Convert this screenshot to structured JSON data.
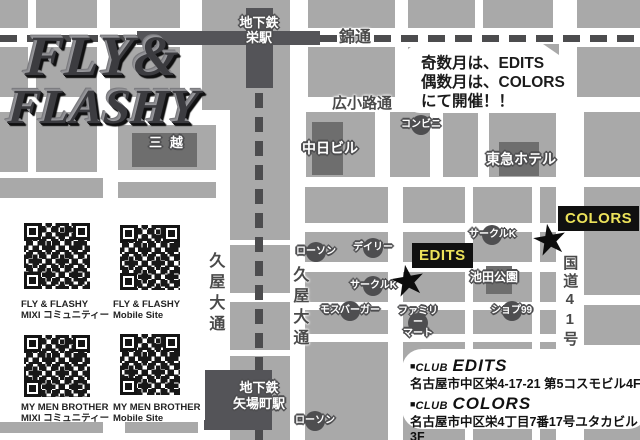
{
  "logo": {
    "line1": "FLY&",
    "line2": "FLASHY"
  },
  "announcement": {
    "line1": "奇数月は、EDITS",
    "line2": "偶数月は、COLORS",
    "line3": "にて開催！！"
  },
  "map": {
    "stations": {
      "sakae": [
        "地下鉄",
        "栄駅"
      ],
      "yabacho": [
        "地下鉄",
        "矢場町駅"
      ]
    },
    "streets": {
      "nishiki": "錦通",
      "hirokoji": "広小路通",
      "hisaya_left": "久屋大通",
      "hisaya_right": "久屋大通",
      "route41": "国道41号"
    },
    "places": {
      "mitsukoshi": "三越",
      "chunichi": "中日ビル",
      "tokyu": "東急ホテル",
      "ikeda": "池田公園"
    },
    "stores": {
      "conbini": "コンビニ",
      "lawson_mid": "ローソン",
      "daily": "デイリー",
      "circlek_upper": "サークルK",
      "circlek_lower": "サークルK",
      "mos": "モスバーガー",
      "famima_line1": "ファミリー",
      "famima_line2": "マート",
      "shop99": "ショプ99",
      "lawson_bottom": "ローソン"
    },
    "venues": {
      "edits": "EDITS",
      "colors": "COLORS",
      "star": "★"
    }
  },
  "qr": {
    "items": [
      {
        "line1": "FLY & FLASHY",
        "line2": "MIXI コミュニティー"
      },
      {
        "line1": "FLY & FLASHY",
        "line2": "Mobile Site"
      },
      {
        "line1": "MY MEN BROTHER",
        "line2": "MIXI コミュニティー"
      },
      {
        "line1": "MY MEN BROTHER",
        "line2": "Mobile Site"
      }
    ]
  },
  "clubs": {
    "edits": {
      "bullet": "■",
      "club": "CLUB",
      "name": "EDITS",
      "address": "名古屋市中区栄4-17-21 第5コスモビル4F"
    },
    "colors": {
      "bullet": "■",
      "club": "CLUB",
      "name": "COLORS",
      "address": "名古屋市中区栄4丁目7番17号ユタカビル3F"
    }
  },
  "colors": {
    "accent_yellow": "#ece25a",
    "flag_black": "#101010",
    "block_gray": "#a9a9a9",
    "building_gray": "#6e6e6e",
    "station_gray": "#545458"
  }
}
